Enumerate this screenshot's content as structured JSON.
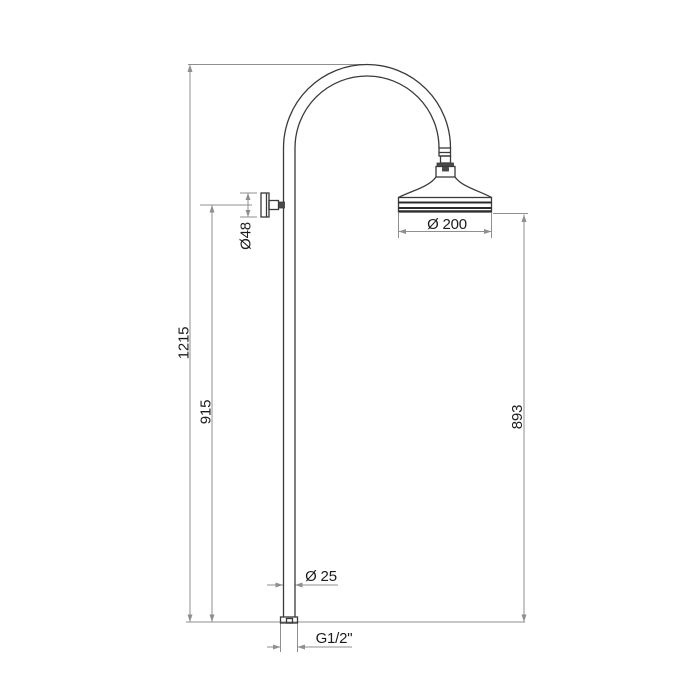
{
  "drawing": {
    "type": "technical-dimension-drawing",
    "subject": "wall-mounted shower column with curved arm and bell shower head"
  },
  "colors": {
    "background": "#ffffff",
    "outline": "#3a3a3a",
    "dimension_lines": "#8f8f8f",
    "label_text": "#1c1c1c"
  },
  "dimensions": {
    "total_height": "1215",
    "bracket_height": "915",
    "head_height": "893",
    "bracket_diameter": "Ø48",
    "head_diameter": "Ø 200",
    "pipe_diameter": "Ø 25",
    "thread_size": "G1/2\""
  }
}
